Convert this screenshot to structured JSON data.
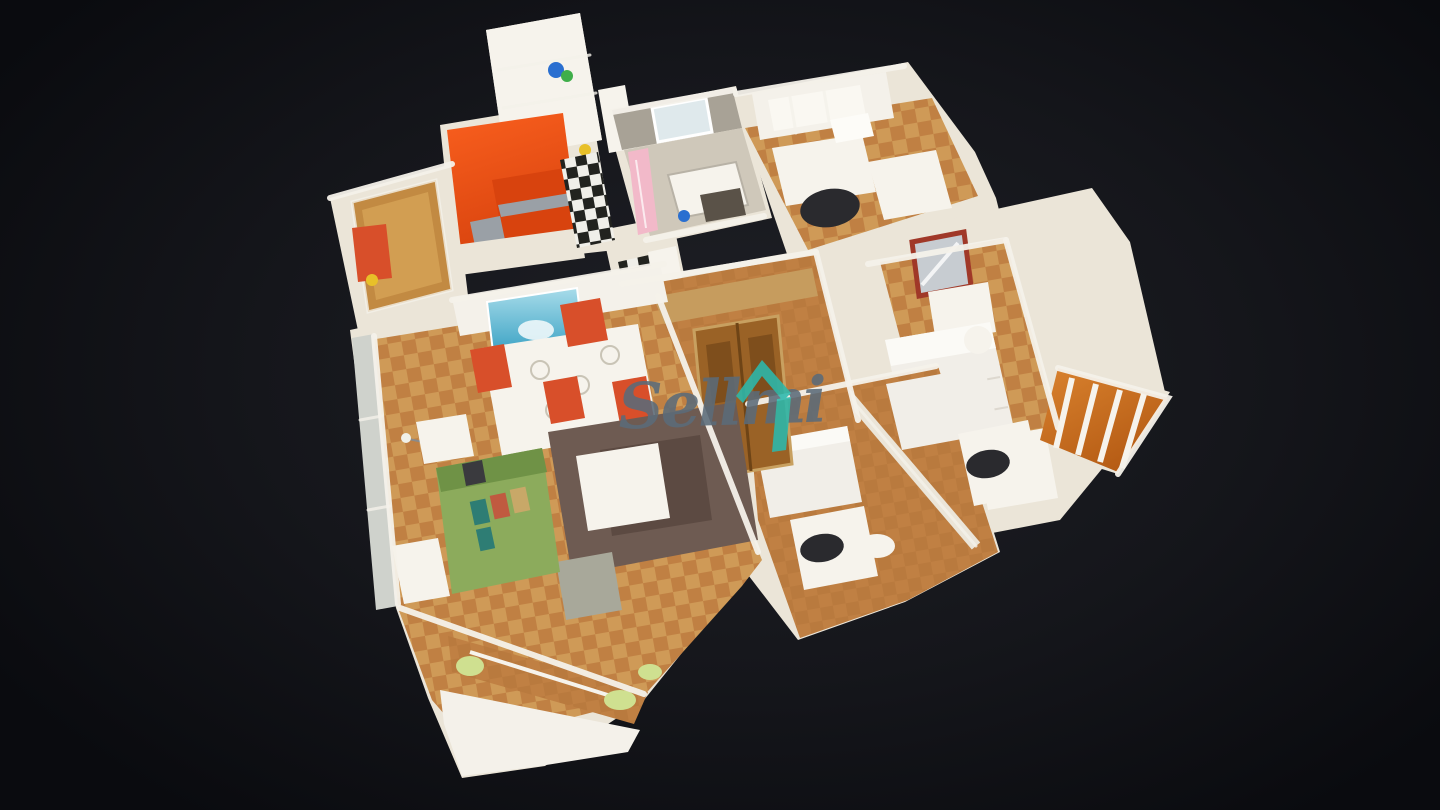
{
  "background": {
    "center": "#1f2026",
    "edge": "#0a0b0f"
  },
  "watermark": {
    "text": "Sellmi",
    "text_color": "#5b6b79",
    "icon": "house-icon",
    "icon_color": "#2bb9ad"
  },
  "scene": {
    "palette": {
      "wall_cream": "#ebe5d8",
      "wall_white": "#f4f1ea",
      "wood_light": "#cf9a57",
      "wood_dark": "#c08043",
      "wood_mid": "#b97a3e",
      "oak_door": "#c28a42",
      "dark_oak": "#9a6226",
      "kitchen_orange": "#f95f1e",
      "kitchen_orange_dark": "#d8430e",
      "steel": "#9aa0a6",
      "checker_dark": "#22231f",
      "checker_light": "#f0efe9",
      "concrete": "#a8a296",
      "window_glass": "#dfe9ec",
      "curtain_pink": "#f2b9c9",
      "sofa_green": "#8cab5c",
      "sofa_green_dark": "#6f9246",
      "pillow_teal": "#2e7d74",
      "pillow_red": "#c05a40",
      "pillow_tan": "#c8a868",
      "rug_brown": "#6e5b52",
      "rug_brown_dark": "#5c4a42",
      "chair_red": "#d84f2a",
      "chair_black": "#2a2a2e",
      "bed_white": "#f1eee8",
      "furniture_white": "#f6f3ec",
      "poster_blue": "#2f9cc0",
      "poster_blue_light": "#a8dcea",
      "mirror_frame": "#a03828",
      "mirror_glass": "#c7ccd1",
      "balcony_glow": "#d9822e",
      "balcony_glow_deep": "#b55b14",
      "gallery_green": "#cfe090",
      "glass_gray": "#cfd2cc",
      "item_blue": "#2a6fd0",
      "item_green": "#3fae4a",
      "item_yellow": "#e8c028",
      "wm_text": "#5b6b79",
      "wm_icon": "#2bb9ad"
    }
  }
}
